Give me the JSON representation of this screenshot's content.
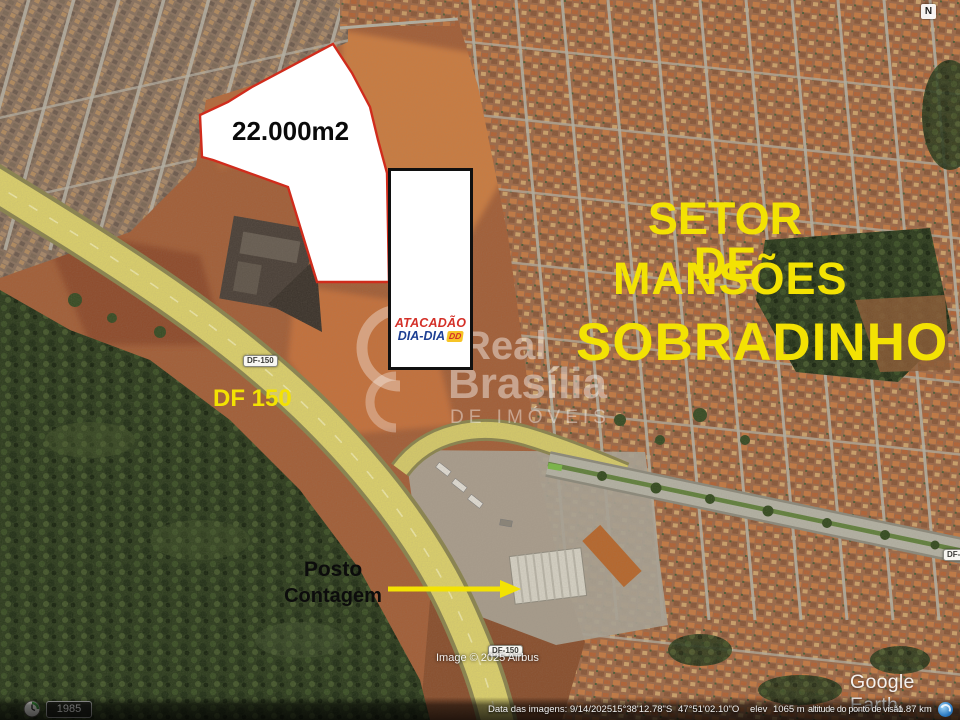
{
  "plot": {
    "area_label": "22.000m2"
  },
  "labels": {
    "setor_line1": "SETOR DE",
    "setor_line2": "MANSÕES",
    "setor_line3": "SOBRADINHO",
    "highway_label": "DF 150",
    "posto_line1": "Posto",
    "posto_line2": "Contagem"
  },
  "store_logo": {
    "name_top": "ATACADÃO",
    "name_bottom": "DIA-DIA",
    "badge": "DD"
  },
  "watermark": {
    "line1": "Real",
    "line2": "Brasília",
    "line3": "DE IMÓVEIS"
  },
  "map": {
    "road_shield_df150_upper": "DF-150",
    "road_shield_df150_lower": "DF-150",
    "road_shield_df4": "DF-4",
    "compass_letter": "N",
    "attribution": "Image © 2025 Airbus",
    "google_earth_logo": "Google Earth",
    "history_year": "1985"
  },
  "status_bar": {
    "imagery_date": "Data das imagens: 9/14/2025",
    "latitude": "15°38'12.78\"S",
    "longitude": "47°51'02.10\"O",
    "elevation_label": "elev",
    "elevation_value": "1065 m",
    "view_altitude_label": "altitude do ponto de visão",
    "view_altitude_value": "1.87 km"
  },
  "colors": {
    "annotation_yellow": "#f3e203",
    "plot_outline_red": "#d02c1c",
    "logo_red": "#d43028",
    "logo_blue": "#1d3f93",
    "logo_badge_yellow": "#f6c426"
  }
}
